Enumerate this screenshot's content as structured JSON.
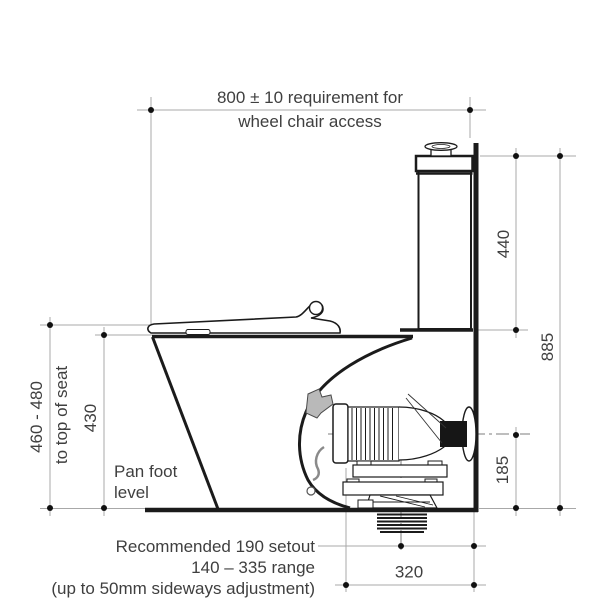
{
  "diagram": {
    "top_note": {
      "line1": "800 ± 10 requirement for",
      "line2": "wheel chair access"
    },
    "left": {
      "seat_height_range": "460 - 480",
      "seat_height_caption": "to top of seat",
      "rim_height": "430",
      "floor_label_line1": "Pan foot",
      "floor_label_line2": "level"
    },
    "right": {
      "cistern_height": "440",
      "overall_height": "885",
      "outlet_centre_height": "185"
    },
    "bottom": {
      "setout_note": "Recommended 190 setout",
      "setout_range": "140 – 335 range",
      "setout_adjustment": "(up to 50mm sideways adjustment)",
      "wall_clearance": "320"
    }
  },
  "colors": {
    "outline": "#1b1b1b",
    "dimension_line": "#a8a8a8",
    "text": "#3f3f3f",
    "background": "#ffffff",
    "bracket_fill": "#b9b9b9",
    "seal_fill": "#161616"
  }
}
